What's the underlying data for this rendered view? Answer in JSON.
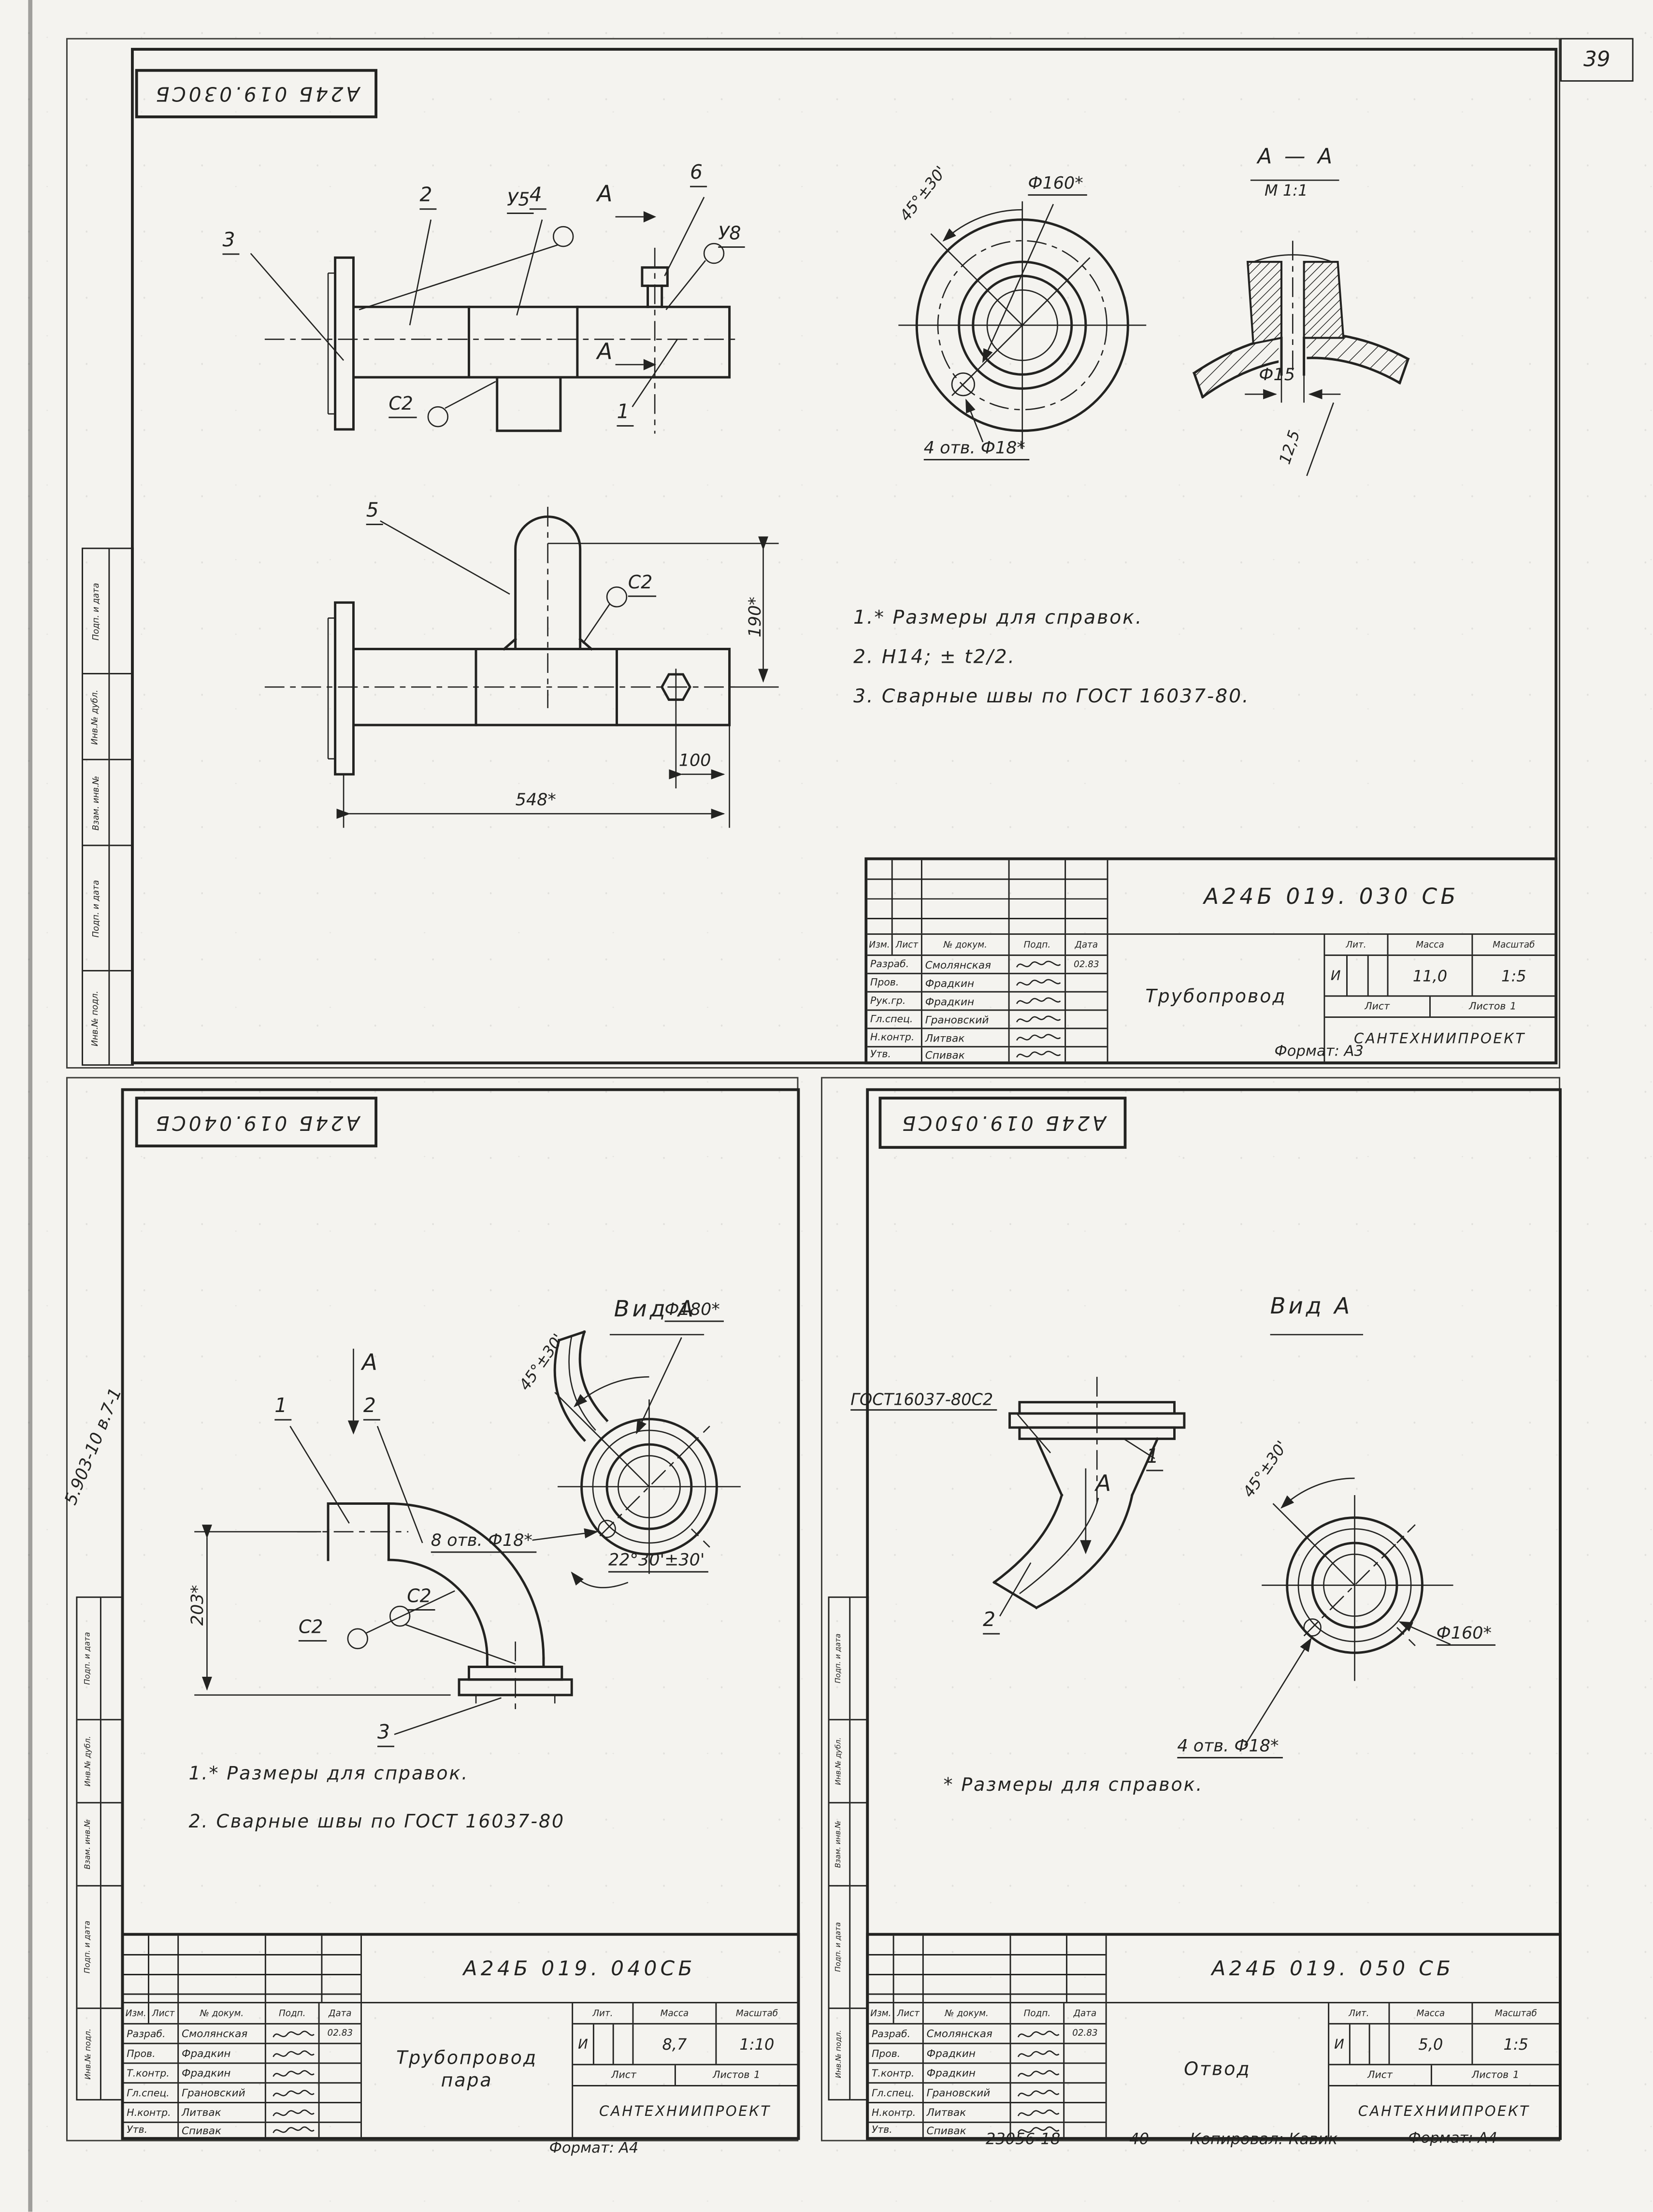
{
  "page": {
    "number": "39",
    "side_note": "5.903-10 в.7-1",
    "margin_labels": [
      "Подп. и дата",
      "Инв.№ дубл.",
      "Взам. инв.№",
      "Подп. и дата",
      "Инв.№ подл."
    ],
    "footer": {
      "order_no": "23056-18",
      "sheet_no": "40",
      "copied_by": "Копировал: Кавик",
      "format_a4": "Формат: А4"
    },
    "ink": "#232321",
    "paper": "#f4f3ef"
  },
  "sheet_top": {
    "stamp": "А24Б 019.030СБ",
    "view_arrow": "А",
    "section": {
      "title": "А — А",
      "scale": "М 1:1"
    },
    "callouts": {
      "c1": "1",
      "c2": "2",
      "c3": "3",
      "c4": "4",
      "c5": "5",
      "c6": "6",
      "y5": "У5",
      "y8": "У8",
      "s2a": "С2",
      "s2b": "С2"
    },
    "dims": {
      "d190": "190*",
      "d100": "100",
      "d548": "548*",
      "angle": "45°±30'",
      "d160": "Ф160*",
      "holes": "4 отв. Ф18*",
      "d15": "Ф15",
      "d125": "12,5"
    },
    "notes": [
      "1.* Размеры для справок.",
      "2. Н14; ± t2/2.",
      "3. Сварные швы по ГОСТ 16037-80."
    ],
    "title_block": {
      "doc_number": "А24Б 019. 030 СБ",
      "name": "Трубопровод",
      "name2": "",
      "header": [
        "Изм.",
        "Лист",
        "№ докум.",
        "Подп.",
        "Дата"
      ],
      "rows": [
        {
          "role": "Разраб.",
          "name": "Смолянская",
          "date": "02.83"
        },
        {
          "role": "Пров.",
          "name": "Фрадкин",
          "date": ""
        },
        {
          "role": "Рук.гр.",
          "name": "Фрадкин",
          "date": ""
        },
        {
          "role": "Гл.спец.",
          "name": "Грановский",
          "date": ""
        },
        {
          "role": "Н.контр.",
          "name": "Литвак",
          "date": ""
        },
        {
          "role": "Утв.",
          "name": "Спивак",
          "date": ""
        }
      ],
      "lit_headers": [
        "Лит.",
        "Масса",
        "Масштаб"
      ],
      "lit": "И",
      "mass": "11,0",
      "scale": "1:5",
      "list_label": "Лист",
      "listov_label": "Листов",
      "listov_value": "1",
      "org": "САНТЕХНИИПРОЕКТ",
      "format": "Формат: А3"
    }
  },
  "sheet_left": {
    "stamp": "А24Б 019.040СБ",
    "view_arrow": "А",
    "view_title": "Вид А",
    "callouts": {
      "c1": "1",
      "c2": "2",
      "c3": "3",
      "s2a": "С2",
      "s2b": "С2"
    },
    "dims": {
      "d203": "203*",
      "angle": "45°±30'",
      "d180": "Ф180*",
      "holes": "8 отв. Ф18*",
      "angle2": "22°30'±30'"
    },
    "notes": [
      "1.* Размеры для справок.",
      "2. Сварные швы по ГОСТ 16037-80"
    ],
    "title_block": {
      "doc_number": "А24Б 019. 040СБ",
      "name": "Трубопровод",
      "name2": "пара",
      "header": [
        "Изм.",
        "Лист",
        "№ докум.",
        "Подп.",
        "Дата"
      ],
      "rows": [
        {
          "role": "Разраб.",
          "name": "Смолянская",
          "date": "02.83"
        },
        {
          "role": "Пров.",
          "name": "Фрадкин",
          "date": ""
        },
        {
          "role": "Т.контр.",
          "name": "Фрадкин",
          "date": ""
        },
        {
          "role": "Гл.спец.",
          "name": "Грановский",
          "date": ""
        },
        {
          "role": "Н.контр.",
          "name": "Литвак",
          "date": ""
        },
        {
          "role": "Утв.",
          "name": "Спивак",
          "date": ""
        }
      ],
      "lit_headers": [
        "Лит.",
        "Масса",
        "Масштаб"
      ],
      "lit": "И",
      "mass": "8,7",
      "scale": "1:10",
      "list_label": "Лист",
      "listov_label": "Листов",
      "listov_value": "1",
      "org": "САНТЕХНИИПРОЕКТ",
      "format": "Формат: А4"
    }
  },
  "sheet_right": {
    "stamp": "А24Б 019.050СБ",
    "view_arrow": "А",
    "view_title": "Вид А",
    "gost_label": "ГОСТ16037-80С2",
    "callouts": {
      "c1": "1",
      "c2": "2"
    },
    "dims": {
      "angle": "45°±30'",
      "d160": "Ф160*",
      "holes": "4 отв. Ф18*"
    },
    "note": "* Размеры для справок.",
    "title_block": {
      "doc_number": "А24Б 019. 050 СБ",
      "name": "Отвод",
      "name2": "",
      "header": [
        "Изм.",
        "Лист",
        "№ докум.",
        "Подп.",
        "Дата"
      ],
      "rows": [
        {
          "role": "Разраб.",
          "name": "Смолянская",
          "date": "02.83"
        },
        {
          "role": "Пров.",
          "name": "Фрадкин",
          "date": ""
        },
        {
          "role": "Т.контр.",
          "name": "Фрадкин",
          "date": ""
        },
        {
          "role": "Гл.спец.",
          "name": "Грановский",
          "date": ""
        },
        {
          "role": "Н.контр.",
          "name": "Литвак",
          "date": ""
        },
        {
          "role": "Утв.",
          "name": "Спивак",
          "date": ""
        }
      ],
      "lit_headers": [
        "Лит.",
        "Масса",
        "Масштаб"
      ],
      "lit": "И",
      "mass": "5,0",
      "scale": "1:5",
      "list_label": "Лист",
      "listov_label": "Листов",
      "listov_value": "1",
      "org": "САНТЕХНИИПРОЕКТ",
      "format": ""
    }
  }
}
